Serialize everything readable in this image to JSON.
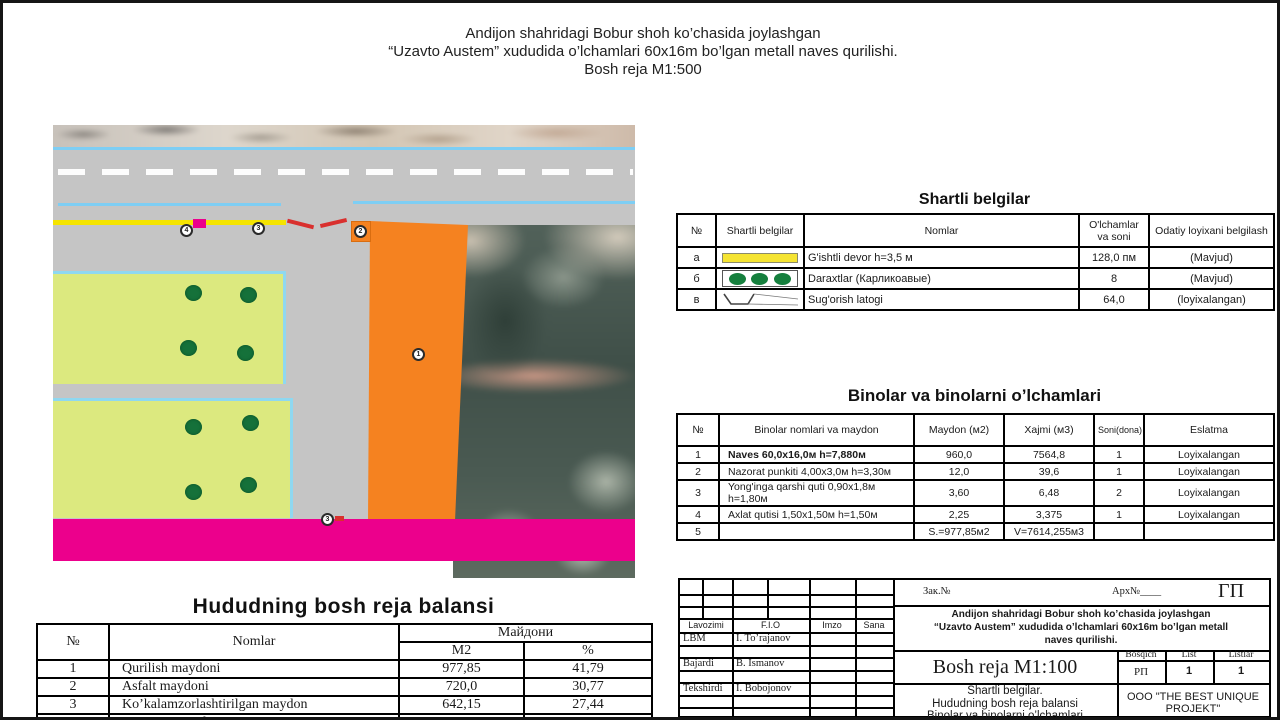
{
  "page": {
    "title_line1": "Andijon shahridagi Bobur shoh ko’chasida joylashgan",
    "title_line2": "“Uzavto Austem” xududida o’lchamlari 60x16m bo’lgan metall naves qurilishi.",
    "title_line3": "Bosh reja M1:500"
  },
  "legend": {
    "title": "Shartli belgilar",
    "headers": {
      "num": "№",
      "symbol": "Shartli belgilar",
      "name": "Nomlar",
      "size": "O'lchamlar va soni",
      "status": "Odatiy loyixani belgilash"
    },
    "rows": [
      {
        "num": "a",
        "symbol": "yellow-wall-symbol",
        "name": "G'ishtli devor  h=3,5 м",
        "size": "128,0 пм",
        "status": "(Mavjud)"
      },
      {
        "num": "б",
        "symbol": "dwarf-trees-symbol",
        "name": "Daraxtlar (Карликоавые)",
        "size": "8",
        "status": "(Mavjud)"
      },
      {
        "num": "в",
        "symbol": "irrigation-tray-symbol",
        "name": "Sug'orish latogi",
        "size": "64,0",
        "status": "(loyixalangan)"
      }
    ]
  },
  "buildings": {
    "title": "Binolar va binolarni o’lchamlari",
    "headers": {
      "num": "№",
      "name": "Binolar nomlari va maydon",
      "area": "Maydon (м2)",
      "volume": "Xajmi (м3)",
      "qty": "Soni(dona)",
      "note": "Eslatma"
    },
    "rows": [
      {
        "num": "1",
        "name": "Naves   60,0x16,0м  h=7,880м",
        "area": "960,0",
        "volume": "7564,8",
        "qty": "1",
        "note": "Loyixalangan"
      },
      {
        "num": "2",
        "name": "Nazorat punkiti   4,00x3,0м  h=3,30м",
        "area": "12,0",
        "volume": "39,6",
        "qty": "1",
        "note": "Loyixalangan"
      },
      {
        "num": "3",
        "name": "Yong'inga qarshi quti    0,90x1,8м  h=1,80м",
        "area": "3,60",
        "volume": "6,48",
        "qty": "2",
        "note": "Loyixalangan"
      },
      {
        "num": "4",
        "name": "Axlat qutisi    1,50x1,50м  h=1,50м",
        "area": "2,25",
        "volume": "3,375",
        "qty": "1",
        "note": "Loyixalangan"
      },
      {
        "num": "5",
        "name": "",
        "area": "S.=977,85м2",
        "volume": "V=7614,255м3",
        "qty": "",
        "note": ""
      }
    ]
  },
  "balance": {
    "title": "Hududning bosh reja balansi",
    "headers": {
      "num": "№",
      "name": "Nomlar",
      "area_group": "Майдони",
      "m2": "M2",
      "pct": "%"
    },
    "rows": [
      {
        "num": "1",
        "name": "Qurilish maydoni",
        "m2": "977,85",
        "pct": "41,79"
      },
      {
        "num": "2",
        "name": "Asfalt maydoni",
        "m2": "720,0",
        "pct": "30,77"
      },
      {
        "num": "3",
        "name": "Ko’kalamzorlashtirilgan maydon",
        "m2": "642,15",
        "pct": "27,44"
      },
      {
        "num": "4",
        "name": "Umumiy maydon",
        "m2": "2340,0",
        "pct": "100"
      }
    ]
  },
  "stamp": {
    "zak": "Зак.№",
    "arx": "Арх№____",
    "gp": "ГП",
    "project_line1": "Andijon shahridagi Bobur shoh ko’chasida joylashgan",
    "project_line2": "“Uzavto Austem” xududida o’lchamlari 60x16m bo’lgan metall",
    "project_line3": "naves qurilishi.",
    "cols": {
      "lavozimi": "Lavozimi",
      "fio": "F.I.O",
      "imzo": "Imzo",
      "sana": "Sana"
    },
    "people": [
      {
        "role": "LBM",
        "name": "I. To’rajanov"
      },
      {
        "role": "Bajardi",
        "name": "B. Ismanov"
      },
      {
        "role": "Tekshirdi",
        "name": "I. Bobojonov"
      }
    ],
    "drawing_title": "Bosh reja M1:100",
    "stage": {
      "bosqich_label": "Bosqich",
      "list_label": "List",
      "listlar_label": "Listlar",
      "bosqich": "РП",
      "list": "1",
      "listlar": "1"
    },
    "content_line1": "Shartli belgilar.",
    "content_line2": "Hududning bosh reja balansi",
    "content_line3": "Binolar va binolarni o’lchamlari",
    "company_line1": "OOO \"THE BEST UNIQUE",
    "company_line2": "PROJEKT\""
  },
  "plan": {
    "markers": [
      {
        "label": "4"
      },
      {
        "label": "3"
      },
      {
        "label": "2"
      },
      {
        "label": "1"
      },
      {
        "label": "3"
      }
    ],
    "colors": {
      "naves_orange": "#F58220",
      "boundary_magenta": "#EC008C",
      "green_area": "#DCE97F",
      "tree_green": "#15713A",
      "wall_yellow": "#F5E400",
      "curb_cyan": "#7ECEF4",
      "gate_red": "#D9302E",
      "road_gray": "#C5C5C5"
    }
  }
}
